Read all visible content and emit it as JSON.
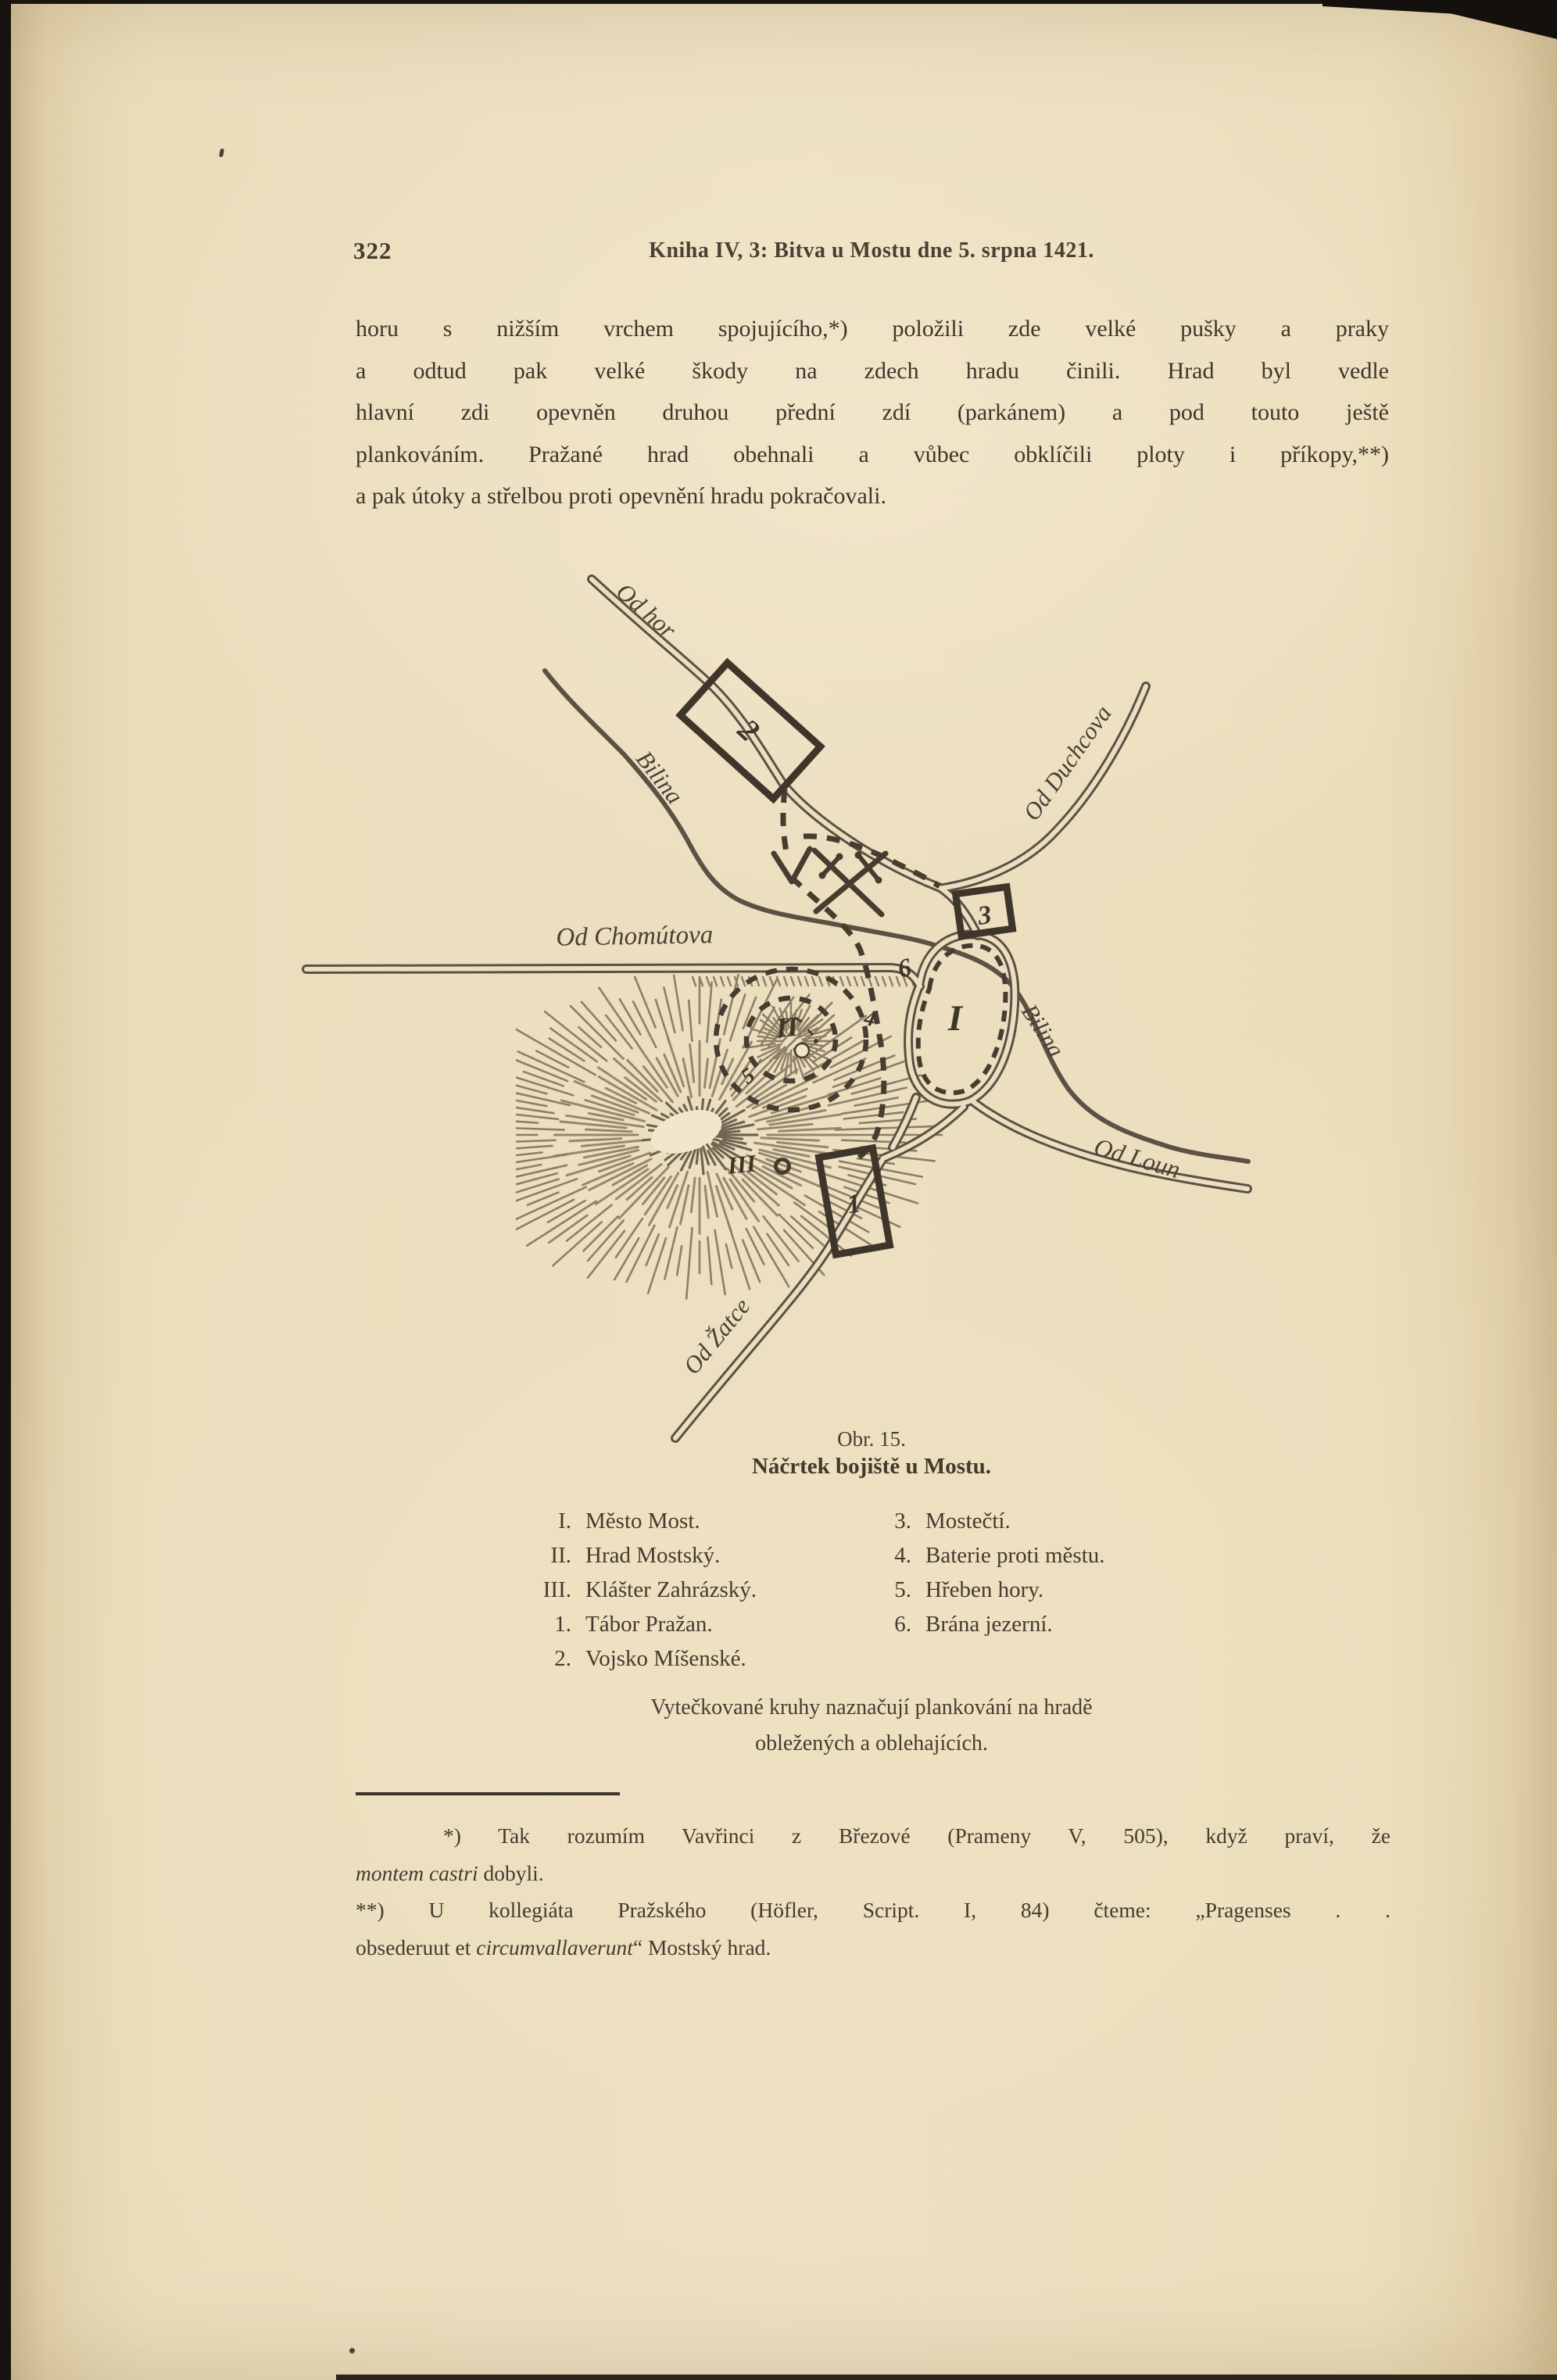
{
  "page_number": "322",
  "running_header": "Kniha IV, 3: Bitva u Mostu dne 5. srpna 1421.",
  "paragraph": {
    "lines": [
      "horu s nižším vrchem spojujícího,*) položili zde velké pušky a praky",
      "a odtud pak velké škody na zdech hradu činili. Hrad byl vedle",
      "hlavní zdi opevněn druhou přední zdí (parkánem) a pod touto ještě",
      "plankováním. Pražané hrad obehnali a vůbec obklíčili ploty i příkopy,**)",
      "a pak útoky a střelbou proti opevnění hradu pokračovali."
    ]
  },
  "figure": {
    "caption_number": "Obr. 15.",
    "caption_title": "Náčrtek bojiště u Mostu.",
    "map_labels": {
      "road_od_hor": "Od hor",
      "river_bilina_upper": "Bilina",
      "road_od_duchcova": "Od Duchcova",
      "road_od_chomutova": "Od Chomútova",
      "river_bilina_lower": "Bilina",
      "road_od_loun": "Od Loun",
      "road_od_zatce": "Od Žatce",
      "city": "I",
      "castle": "II",
      "monastery": "III",
      "camp_prague": "1",
      "camp_meissen": "2",
      "mostecti": "3",
      "battery": "4",
      "ridge": "5",
      "gate": "6"
    },
    "legend_left": [
      {
        "num": "I.",
        "label": "Město Most."
      },
      {
        "num": "II.",
        "label": "Hrad Mostský."
      },
      {
        "num": "III.",
        "label": "Klášter Zahrázský."
      },
      {
        "num": "1.",
        "label": "Tábor Pražan."
      },
      {
        "num": "2.",
        "label": "Vojsko Míšenské."
      }
    ],
    "legend_right": [
      {
        "num": "3.",
        "label": "Mostečtí."
      },
      {
        "num": "4.",
        "label": "Baterie proti městu."
      },
      {
        "num": "5.",
        "label": "Hřeben hory."
      },
      {
        "num": "6.",
        "label": "Brána jezerní."
      }
    ],
    "note_lines": [
      "Vytečkované kruhy naznačují plankování na hradě",
      "obležených a oblehajících."
    ]
  },
  "footnotes": {
    "line1": [
      {
        "t": "*) Tak rozumím Vavřinci z Březové (Prameny V, 505), když praví, že",
        "i": false
      }
    ],
    "line2": [
      {
        "t": "montem castri",
        "i": true
      },
      {
        "t": " dobyli.",
        "i": false
      }
    ],
    "line3": [
      {
        "t": "**) U kollegiáta Pražského (Höfler, Script. I, 84) čteme: „Pragenses . .",
        "i": false
      }
    ],
    "line4": [
      {
        "t": "obsederuut et ",
        "i": false
      },
      {
        "t": "circumvallaverunt",
        "i": true
      },
      {
        "t": "“ Mostský hrad.",
        "i": false
      }
    ]
  }
}
